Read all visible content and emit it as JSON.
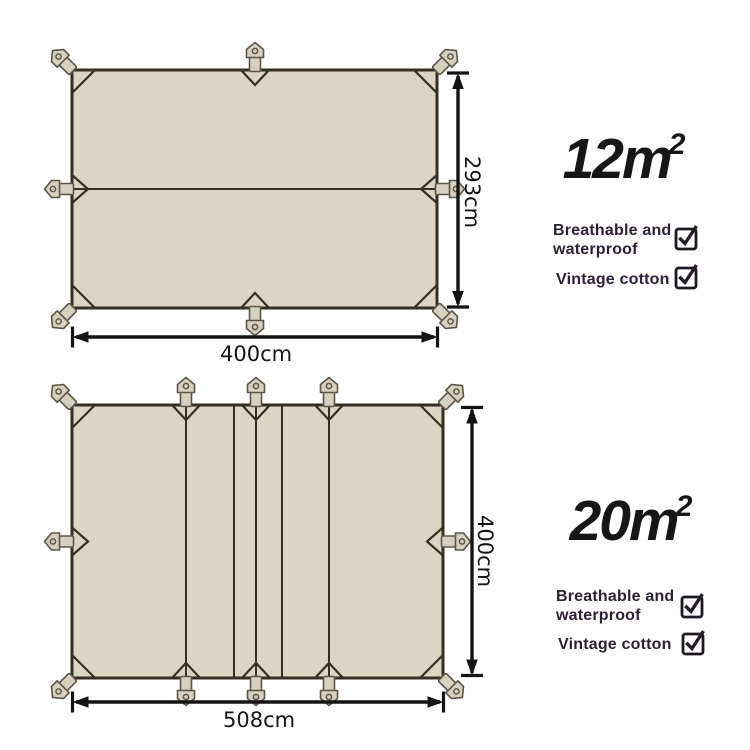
{
  "colors": {
    "background": "#ffffff",
    "tarp_fill": "#dcd5c3",
    "tarp_outline": "#362f25",
    "hardware_fill": "#d7d0be",
    "hardware_stroke": "#5c5547",
    "dimension": "#141414",
    "area_text": "#161616",
    "feature_text": "#2d2133",
    "checkbox_border": "#1c1721",
    "checkmark": "#221d26"
  },
  "icons": {
    "checkbox_checked": "✓",
    "tie_buckle": "pentagon-buckle-with-hole"
  },
  "diagrams": [
    {
      "name": "12 square meter tarp",
      "area_value": "12m",
      "area_sup": "2",
      "width_label": "400cm",
      "height_label": "293cm",
      "features": [
        {
          "label": "Breathable and waterproof",
          "checked": true
        },
        {
          "label": "Vintage cotton",
          "checked": true
        }
      ]
    },
    {
      "name": "20 square meter tarp",
      "area_value": "20m",
      "area_sup": "2",
      "width_label": "508cm",
      "height_label": "400cm",
      "features": [
        {
          "label": "Breathable and waterproof",
          "checked": true
        },
        {
          "label": "Vintage cotton",
          "checked": true
        }
      ]
    }
  ]
}
